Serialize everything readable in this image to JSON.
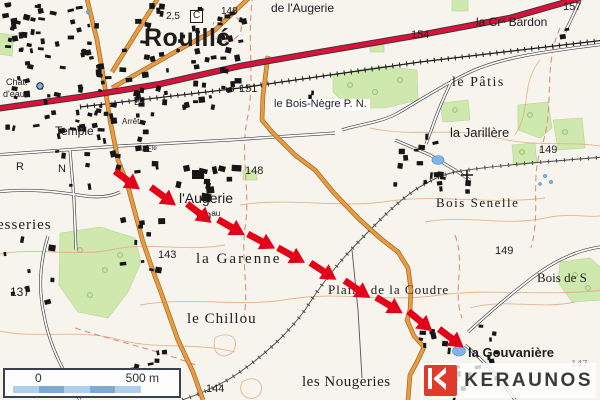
{
  "palette": {
    "background": "#f7f4ed",
    "woods": "#cfe8ad",
    "tree_ring": "#8fbf6a",
    "road_orange": "#ec9a42",
    "road_orange_casing": "#9a6a20",
    "road_red": "#d8123a",
    "road_casing": "#333333",
    "minor_road": "#3d3d3d",
    "contour": "#e0ac80",
    "boundary_dash": "#d89278",
    "water": "#7fb4e6",
    "building": "#161616",
    "arrow_red": "#e50019"
  },
  "labels": [
    {
      "text": "Rouillé",
      "x": 144,
      "y": 26,
      "size": 25,
      "style": "sans",
      "bold": true,
      "spacing": 0.5
    },
    {
      "text": "2,5",
      "x": 166,
      "y": 12,
      "size": 10,
      "style": "sans"
    },
    {
      "text": "C",
      "x": 190,
      "y": 10,
      "size": 10,
      "style": "sans",
      "box": true
    },
    {
      "text": "148",
      "x": 221,
      "y": 7,
      "size": 10,
      "style": "sans"
    },
    {
      "text": "de l'Augerie",
      "x": 271,
      "y": 2,
      "size": 12,
      "style": "sans"
    },
    {
      "text": "157",
      "x": 563,
      "y": 2,
      "size": 11,
      "style": "sans"
    },
    {
      "text": "154",
      "x": 411,
      "y": 30,
      "size": 11,
      "style": "sans"
    },
    {
      "text": "la Crˣ Bardon",
      "x": 476,
      "y": 16,
      "size": 12,
      "style": "sans"
    },
    {
      "text": "le Pâtis",
      "x": 452,
      "y": 76,
      "size": 14,
      "style": "serif",
      "spacing": 1.5
    },
    {
      "text": "le Bois-Nègre P. N.",
      "x": 271,
      "y": 99,
      "size": 11,
      "style": "sans",
      "bg": true
    },
    {
      "text": "151",
      "x": 239,
      "y": 84,
      "size": 11,
      "style": "sans"
    },
    {
      "text": "la Jarillère",
      "x": 450,
      "y": 126,
      "size": 13,
      "style": "sans"
    },
    {
      "text": "149",
      "x": 539,
      "y": 145,
      "size": 11,
      "style": "sans"
    },
    {
      "text": "Bois Senelle",
      "x": 436,
      "y": 196,
      "size": 13,
      "style": "serif",
      "spacing": 1.5
    },
    {
      "text": "149",
      "x": 495,
      "y": 246,
      "size": 11,
      "style": "sans"
    },
    {
      "text": "Bois de S",
      "x": 537,
      "y": 271,
      "size": 13,
      "style": "serif"
    },
    {
      "text": "147",
      "x": 571,
      "y": 360,
      "size": 10,
      "style": "sans",
      "color": "#8a8a8a"
    },
    {
      "text": "la Gouvanière",
      "x": 468,
      "y": 346,
      "size": 13,
      "style": "sans",
      "bold": true
    },
    {
      "text": "les Nougeries",
      "x": 302,
      "y": 375,
      "size": 15,
      "style": "serif",
      "spacing": 0.5
    },
    {
      "text": "Plaine de la Coudre",
      "x": 328,
      "y": 283,
      "size": 13,
      "style": "serif",
      "spacing": 1
    },
    {
      "text": "la Garenne",
      "x": 196,
      "y": 252,
      "size": 15,
      "style": "serif",
      "spacing": 2
    },
    {
      "text": "le Chillou",
      "x": 187,
      "y": 312,
      "size": 15,
      "style": "serif",
      "spacing": 1
    },
    {
      "text": "l'Augerie",
      "x": 179,
      "y": 191,
      "size": 14,
      "style": "sans"
    },
    {
      "text": "Chᵃᵘ",
      "x": 196,
      "y": 209,
      "size": 12,
      "style": "sans"
    },
    {
      "text": "143",
      "x": 158,
      "y": 250,
      "size": 11,
      "style": "sans"
    },
    {
      "text": "148",
      "x": 245,
      "y": 166,
      "size": 11,
      "style": "sans"
    },
    {
      "text": "137",
      "x": 10,
      "y": 286,
      "size": 12,
      "style": "sans"
    },
    {
      "text": "144",
      "x": 206,
      "y": 384,
      "size": 11,
      "style": "sans"
    },
    {
      "text": "Temple",
      "x": 55,
      "y": 125,
      "size": 12,
      "style": "sans"
    },
    {
      "text": "Chât.",
      "x": 6,
      "y": 78,
      "size": 9,
      "style": "sans"
    },
    {
      "text": "d'eau",
      "x": 3,
      "y": 90,
      "size": 9,
      "style": "sans"
    },
    {
      "text": "esseries",
      "x": -3,
      "y": 218,
      "size": 15,
      "style": "serif",
      "spacing": 1
    },
    {
      "text": "R",
      "x": 16,
      "y": 162,
      "size": 11,
      "style": "sans"
    },
    {
      "text": "N",
      "x": 58,
      "y": 164,
      "size": 11,
      "style": "sans"
    },
    {
      "text": "Eˡᵉ",
      "x": 134,
      "y": 98,
      "size": 9,
      "style": "sans"
    },
    {
      "text": "Eˡᵉ",
      "x": 146,
      "y": 145,
      "size": 9,
      "style": "sans"
    },
    {
      "text": "Arrêt",
      "x": 122,
      "y": 118,
      "size": 8,
      "style": "sans"
    }
  ],
  "track": {
    "color": "#e50019",
    "arrows": [
      {
        "x": 127,
        "y": 180,
        "a": 36
      },
      {
        "x": 163,
        "y": 196,
        "a": 36
      },
      {
        "x": 199,
        "y": 213,
        "a": 38
      },
      {
        "x": 231,
        "y": 227,
        "a": 30
      },
      {
        "x": 261,
        "y": 241,
        "a": 28
      },
      {
        "x": 291,
        "y": 255,
        "a": 29
      },
      {
        "x": 323,
        "y": 271,
        "a": 33
      },
      {
        "x": 357,
        "y": 289,
        "a": 34
      },
      {
        "x": 389,
        "y": 305,
        "a": 31
      },
      {
        "x": 420,
        "y": 321,
        "a": 40
      },
      {
        "x": 451,
        "y": 338,
        "a": 37
      }
    ]
  },
  "scale_bar": {
    "start_label": "0",
    "end_label": "500 m",
    "segment_colors": [
      "#aed0ec",
      "#7fa9d2",
      "#aed0ec",
      "#7fa9d2",
      "#aed0ec"
    ]
  },
  "logo": {
    "text": "KERAUNOS",
    "mark_color": "#e03a2d",
    "text_color": "#3a3a3a"
  }
}
